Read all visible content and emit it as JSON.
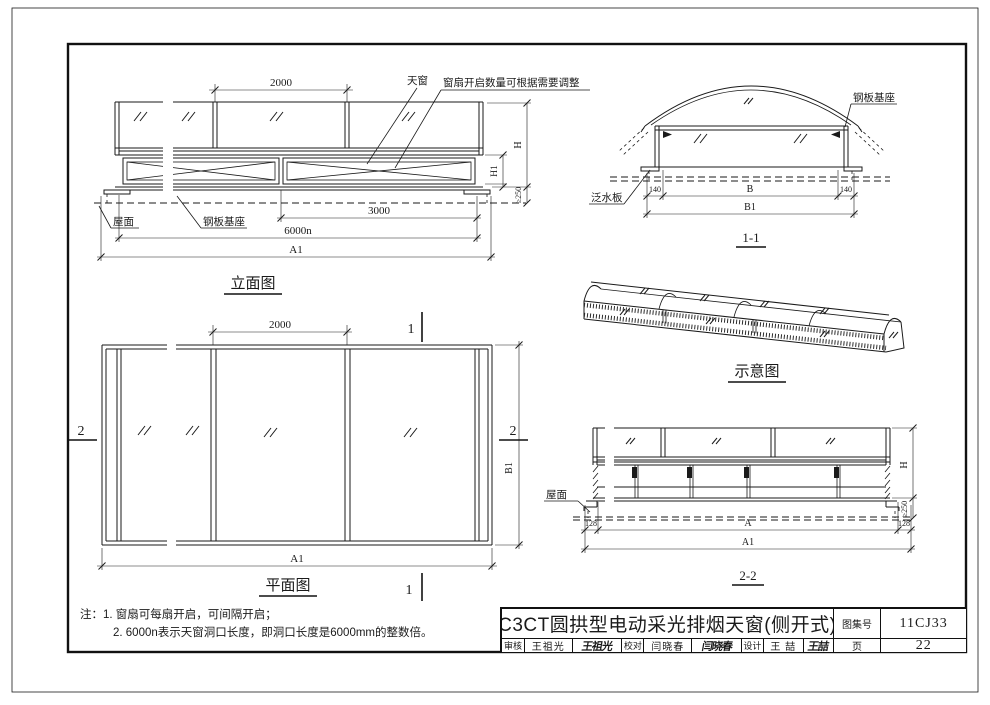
{
  "page": {
    "bg": "#ffffff",
    "line_color": "#1a1a1a"
  },
  "elevation": {
    "title": "立面图",
    "dim_2000": "2000",
    "dim_3000": "3000",
    "dim_6000n": "6000n",
    "dim_a1": "A1",
    "dim_h": "H",
    "dim_h1": "H1",
    "dim_min250": "≥250",
    "label_skylight": "天窗",
    "label_sash_note": "窗扇开启数量可根据需要调整",
    "label_roof": "屋面",
    "label_base": "钢板基座"
  },
  "section_1_1": {
    "title": "1-1",
    "dim_140": "140",
    "dim_b": "B",
    "dim_b1": "B1",
    "label_base": "钢板基座",
    "label_flashing": "泛水板"
  },
  "schematic": {
    "title": "示意图"
  },
  "plan": {
    "title": "平面图",
    "dim_2000": "2000",
    "dim_a1": "A1",
    "dim_b1": "B1",
    "mark_1": "1",
    "mark_2": "2"
  },
  "section_2_2": {
    "title": "2-2",
    "dim_128": "128",
    "dim_a": "A",
    "dim_a1": "A1",
    "dim_h": "H",
    "dim_min250": "≥250",
    "label_roof": "屋面"
  },
  "notes": {
    "prefix": "注：",
    "line1": "1. 窗扇可每扇开启，可间隔开启；",
    "line2": "2. 6000n表示天窗洞口长度，即洞口长度是6000mm的整数倍。"
  },
  "titleblock": {
    "title": "C3CT圆拱型电动采光排烟天窗(侧开式)",
    "atlas_no_label": "图集号",
    "atlas_no": "11CJ33",
    "page_label": "页",
    "page_no": "22",
    "reviewer_label": "审核",
    "reviewer": "王祖光",
    "reviewer_sig": "王祖光",
    "checker_label": "校对",
    "checker": "闫晓春",
    "checker_sig": "闫晓春",
    "designer_label": "设计",
    "designer": "王 喆",
    "designer_sig": "王喆"
  }
}
